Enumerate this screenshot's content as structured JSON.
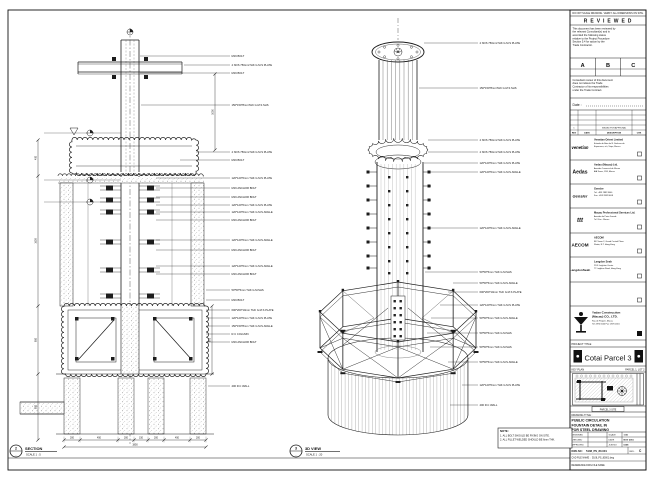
{
  "sheet": {
    "header_note": "DO NOT SCALE DRAWING. VERIFY ALL DIMENSIONS ON SITE.",
    "line_color": "#1c1c1c",
    "paper_color": "#ffffff"
  },
  "reviewed": {
    "title": "R E V I E W E D",
    "body": "This document has been reviewed by the relevant Consultant(s) and is accorded the following status relative to the Project Procedure Section 5.4 for action by the Trade Contractor.",
    "statuses": [
      "A",
      "B",
      "C"
    ],
    "note": "Consultant review of this document does not relieve the Trade Contractor of its responsibilities under the Trade Contract.",
    "date_label": "Date :"
  },
  "revision_table": {
    "rows": [
      [
        "",
        "",
        "",
        ""
      ],
      [
        "",
        "",
        "",
        ""
      ],
      [
        "",
        "",
        "",
        ""
      ],
      [
        "1",
        "",
        "ISSUED FOR APPROVAL",
        ""
      ],
      [
        "REV",
        "DATE",
        "DESCRIPTION",
        "CHK"
      ]
    ]
  },
  "consultants": [
    {
      "logo": "venetian",
      "name": "Venetian Orient Limited",
      "lines": [
        "Estrada da Baia de N. Senhora da",
        "Esperanca, s/n, Taipa, Macau"
      ]
    },
    {
      "logo": "Aedas",
      "name": "Aedas (Macau) Ltd.",
      "lines": [
        "Avenida Comercial de Macau",
        "AIA Tower, 19/F, Macau"
      ]
    },
    {
      "logo": "Gensler",
      "name": "Gensler",
      "lines": [
        "Tel: +853 2882 8000",
        "Fax: +853 2882 8008"
      ]
    },
    {
      "logo": "ttt",
      "name": "Macau Professional Services Ltd.",
      "lines": [
        "Avenida da Praia Grande",
        "Tel / Fax : Macau"
      ]
    },
    {
      "logo": "AECOM",
      "name": "AECOM",
      "lines": [
        "8/F Tower 2, Grand Central Plaza",
        "Shatin, N.T. Hong Kong"
      ]
    },
    {
      "logo": "LangdonSeah",
      "name": "Langdon Seah",
      "lines": [
        "2101 Leighton Centre",
        "77 Leighton Road, Hong Kong"
      ]
    },
    {
      "logo": "",
      "name": "",
      "lines": []
    }
  ],
  "contractor": {
    "name": "Yadao Construction",
    "name2": "(Macau) CO., LTD.",
    "lines": [
      "Rua de Pequim, Macau",
      "Tel: 2870 0000  Fax: 2870 0001"
    ]
  },
  "project": {
    "label": "PROJECT TITLE",
    "name": "Cotai Parcel 3"
  },
  "key_plan": {
    "label": "KEY PLAN",
    "right_label": "PARCEL 1, LOT 2",
    "marker_label": "PARCEL 3 SITE"
  },
  "drawing": {
    "title_label": "DRAWING TITLE :",
    "title_lines": [
      "PUBLIC CIRCULATION",
      "FOUNTAIN DETAIL IN",
      "FOR STEEL DRAWING"
    ],
    "fields": [
      {
        "label": "DESIGNED",
        "value": ""
      },
      {
        "label": "CHECKED",
        "value": ""
      },
      {
        "label": "APPROVED",
        "value": ""
      }
    ],
    "fields2": [
      {
        "label": "SCALE",
        "value": "1:50"
      },
      {
        "label": "DATE",
        "value": "NOV 2015"
      },
      {
        "label": "JOB NO",
        "value": "5108"
      }
    ],
    "dwg_no_label": "DWG NO :",
    "dwg_no": "5108_PS_80-001",
    "rev_label": "REV :",
    "rev": "C",
    "file_label": "CAD FILE NAME :",
    "file": "5108_PS_80001.dwg",
    "ref_label": "REFERENCE DWG FILE NAME"
  },
  "notes": {
    "title": "NOTE:",
    "items": [
      "1. ALL BOLT SHOULD BE FIXING ON SITE.",
      "2. ALL FILLET WELDED SHOULD BE 6mm THK."
    ]
  },
  "section_view": {
    "bubble_no": "2",
    "bubble_ref": "-",
    "label": "SECTION",
    "scale": "SCALE 1 : 5",
    "callouts": [
      "M16 BOLT",
      "4 NOS 750mmTHK G.M.S PLATE",
      "M16 BOLT",
      "150*150*8mmTHK G.M.S SHS",
      "4 NOS 750mmTHK G.M.S PLATE",
      "M16 BOLT",
      "120*120*6mm THK G.M.S PLATE",
      "M16 ANCHOR BOLT",
      "M16 ANCHOR BOLT",
      "120*120*6mm THK G.M.S PLATE",
      "120*120*6mm THK G.M.S ANGLE",
      "M16 ANCHOR BOLT",
      "120*120*6mm THK G.M.S ANGLE",
      "M16 ANCHOR BOLT",
      "120*120*6mm THK G.M.S ANGLE",
      "M16 ANCHOR BOLT",
      "50*50*5mm THK G.M.SHS",
      "M16 BOLT",
      "600*200*10mm THK G.M.S PLATE",
      "120*120*6mm THK G.M.S PLATE",
      "150*150*8mm THK G.M.S ANGLE",
      "R.C COLUMN",
      "M16 ANCHOR BOLT",
      "400 R.C WALL"
    ],
    "dims_bottom": [
      "200",
      "450",
      "200",
      "150",
      "200",
      "450",
      "200"
    ],
    "dims_bottom_total": "1850",
    "dims_left": [
      "400",
      "1600",
      "850",
      "800"
    ],
    "dims_right": [
      "1050",
      "800"
    ]
  },
  "view_3d": {
    "bubble_no": "3",
    "bubble_ref": "-",
    "label": "3D VIEW",
    "scale": "SCALE 1 : 20",
    "callouts": [
      "4 NOS 750mmTHK G.M.S PLATE",
      "150*150*8mmTHK G.M.S SHS",
      "4 NOS 750mmTHK G.M.S PLATE",
      "4 NOS 750mmTHK G.M.S PLATE",
      "120*120*6mm THK G.M.S PLATE",
      "120*120*6mm THK G.M.S ANGLE",
      "120*120*6mm THK G.M.S ANGLE",
      "50*50*5mm THK G.M.SHS",
      "50*50*5mm THK G.M.S ANGLE",
      "600*200*10mm THK G.M.S PLATE",
      "120*120*6mm THK G.M.S PLATE",
      "50*50*5mm THK G.M.S ANGLE",
      "50*50*5mm THK G.M.SHS",
      "50*50*5mm THK G.M.SHS",
      "50*50*5mm THK G.M.S ANGLE",
      "120*120*6mm THK G.M.S PLATE",
      "400 R.C WALL"
    ]
  }
}
